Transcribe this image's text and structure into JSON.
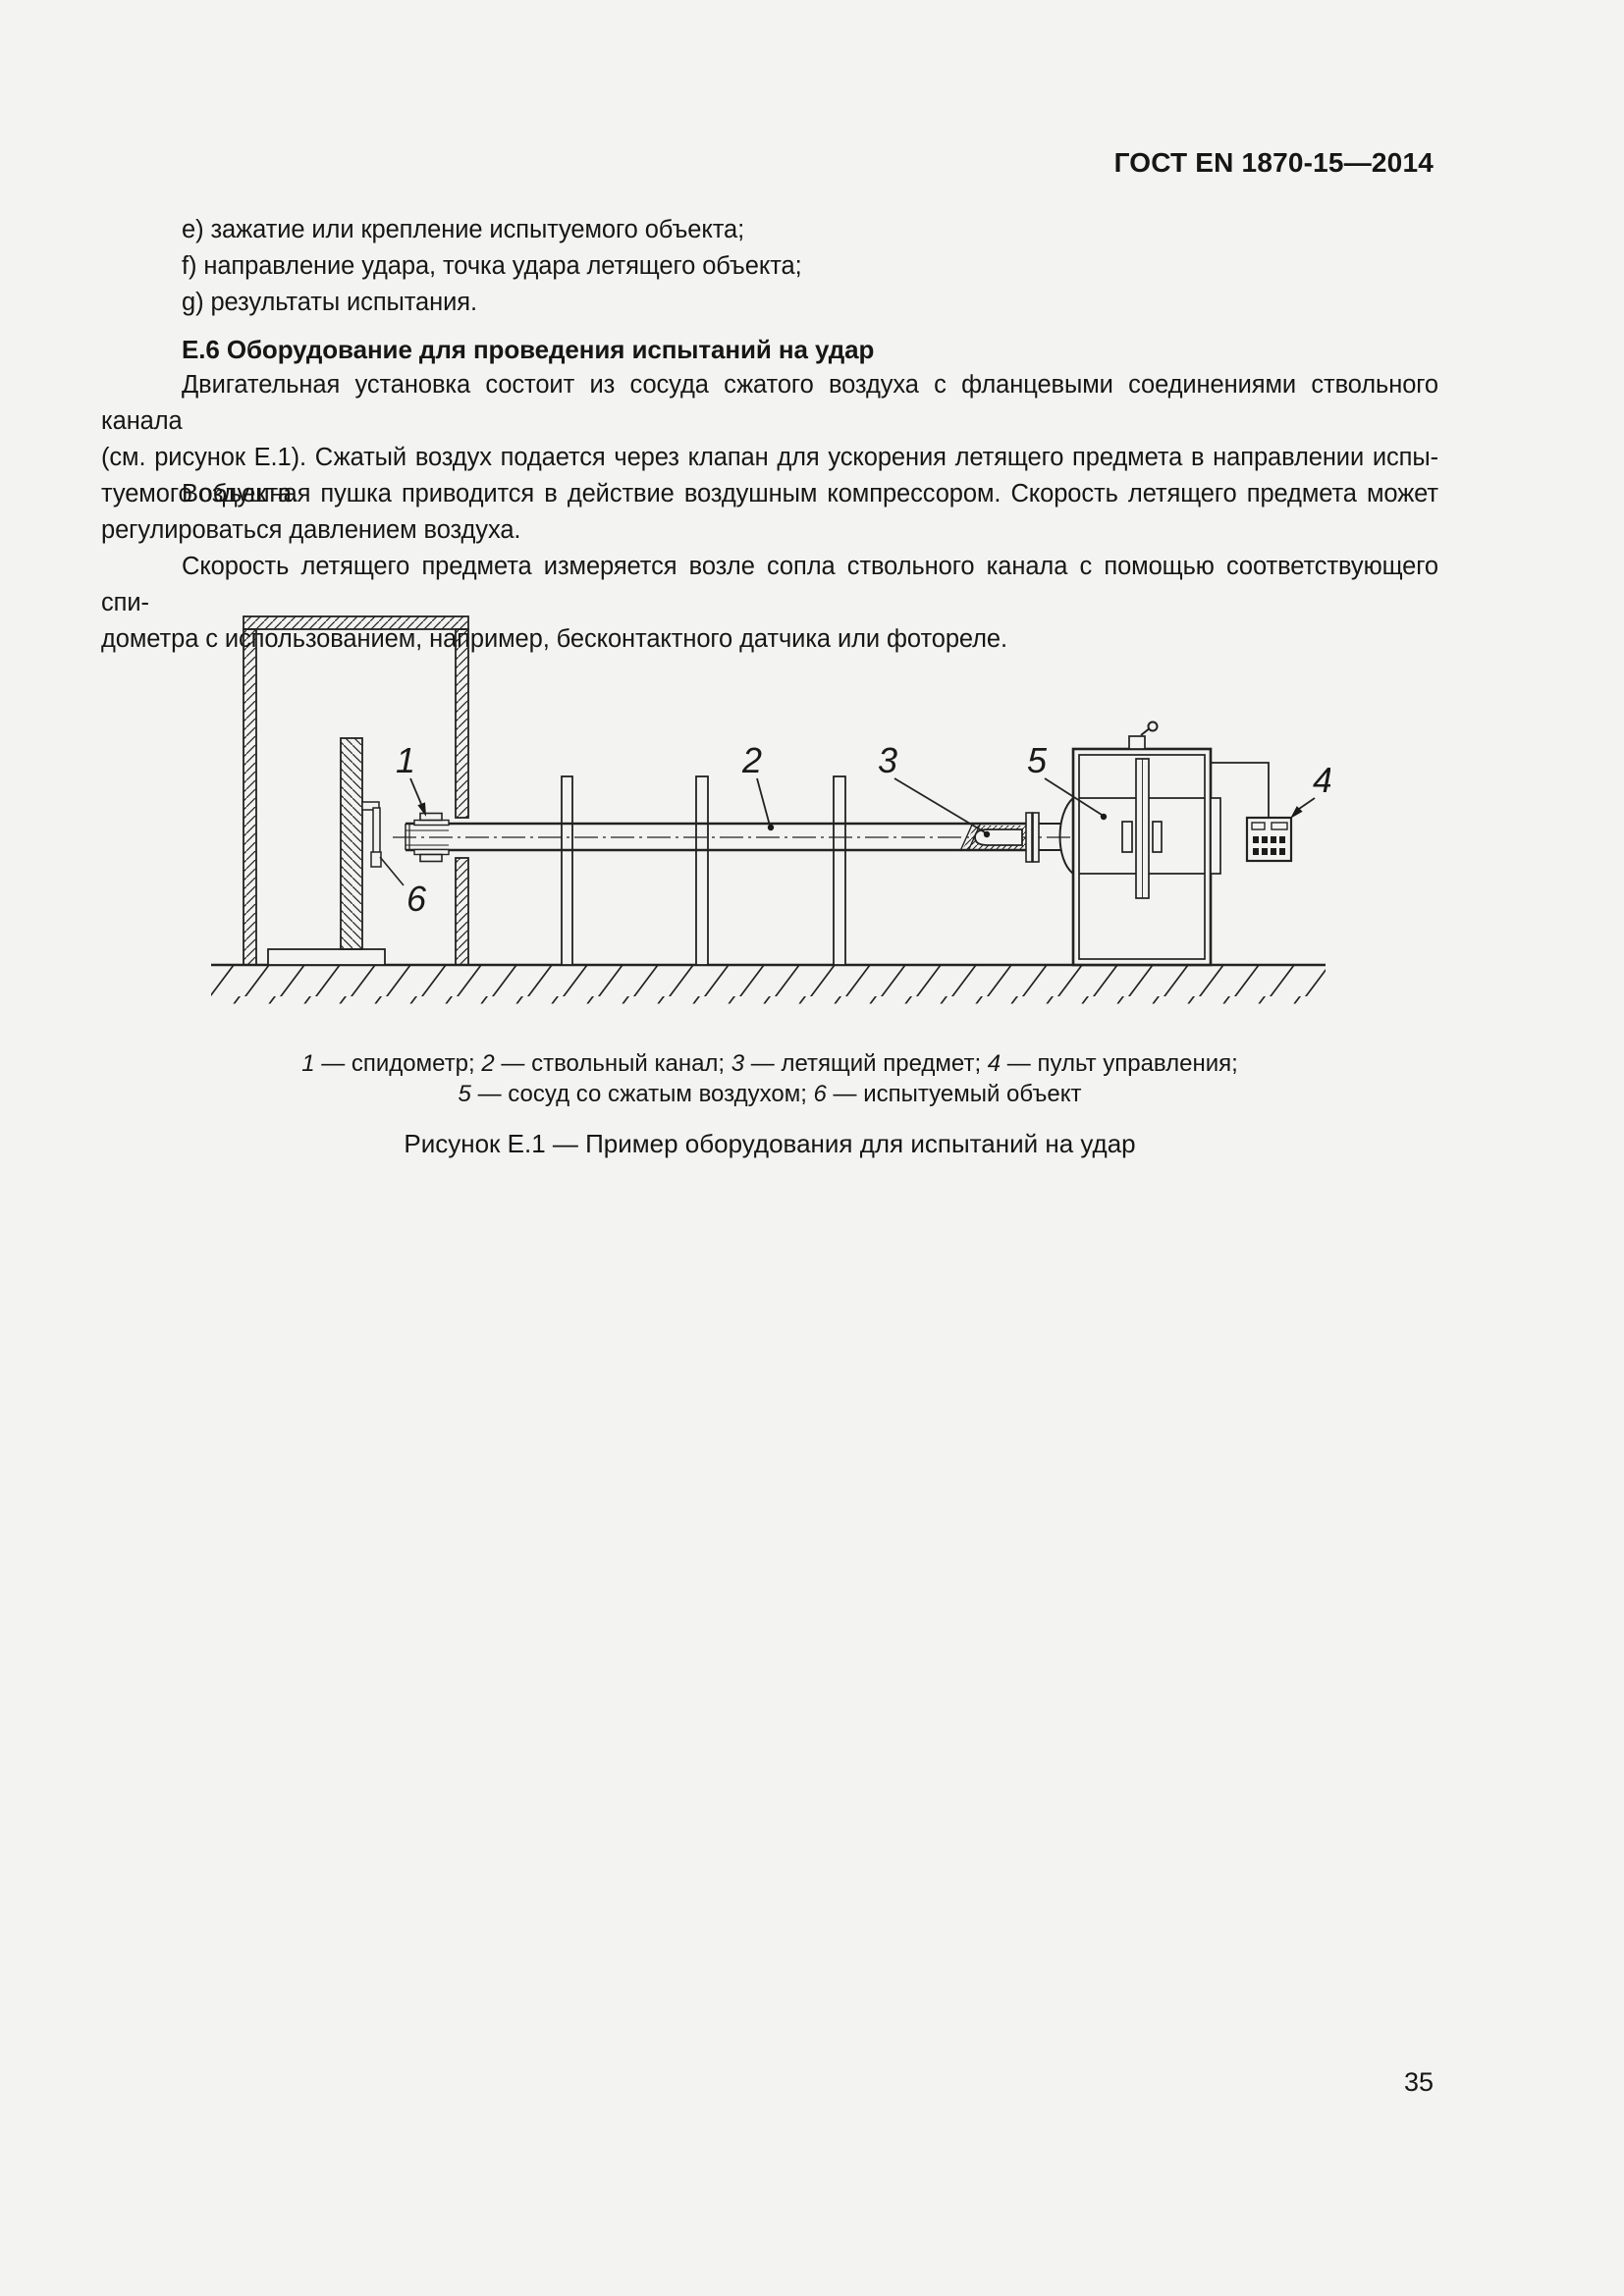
{
  "page": {
    "header": "ГОСТ EN 1870-15—2014",
    "page_number": "35"
  },
  "content": {
    "list_items": [
      "e) зажатие или крепление испытуемого объекта;",
      "f) направление удара, точка удара летящего объекта;",
      "g) результаты испытания."
    ],
    "section_heading": "Е.6 Оборудование для проведения испытаний на удар",
    "paragraphs": [
      {
        "lines": [
          "Двигательная установка состоит из сосуда сжатого воздуха с фланцевыми соединениями ствольного канала",
          "(см. рисунок Е.1). Сжатый воздух подается через клапан для ускорения летящего предмета в направлении испы-",
          "туемого объекта."
        ]
      },
      {
        "lines": [
          "Воздушная пушка приводится в действие воздушным компрессором. Скорость летящего предмета может",
          "регулироваться давлением воздуха."
        ]
      },
      {
        "lines": [
          "Скорость летящего предмета измеряется возле сопла ствольного канала с помощью соответствующего спи-",
          "дометра с использованием, например, бесконтактного датчика или фотореле."
        ]
      }
    ]
  },
  "figure": {
    "diagram_labels": {
      "speedometer": "1",
      "barrel": "2",
      "projectile": "3",
      "panel": "4",
      "vessel": "5",
      "object": "6"
    },
    "legend": [
      {
        "n": "1",
        "t": " — спидометр; "
      },
      {
        "n": "2",
        "t": " — ствольный канал; "
      },
      {
        "n": "3",
        "t": " — летящий предмет; "
      },
      {
        "n": "4",
        "t": " — пульт управления;"
      },
      {
        "n": "5",
        "t": " — сосуд со сжатым воздухом; "
      },
      {
        "n": "6",
        "t": " — испытуемый объект"
      }
    ],
    "caption": "Рисунок Е.1 — Пример оборудования для испытаний на удар"
  }
}
